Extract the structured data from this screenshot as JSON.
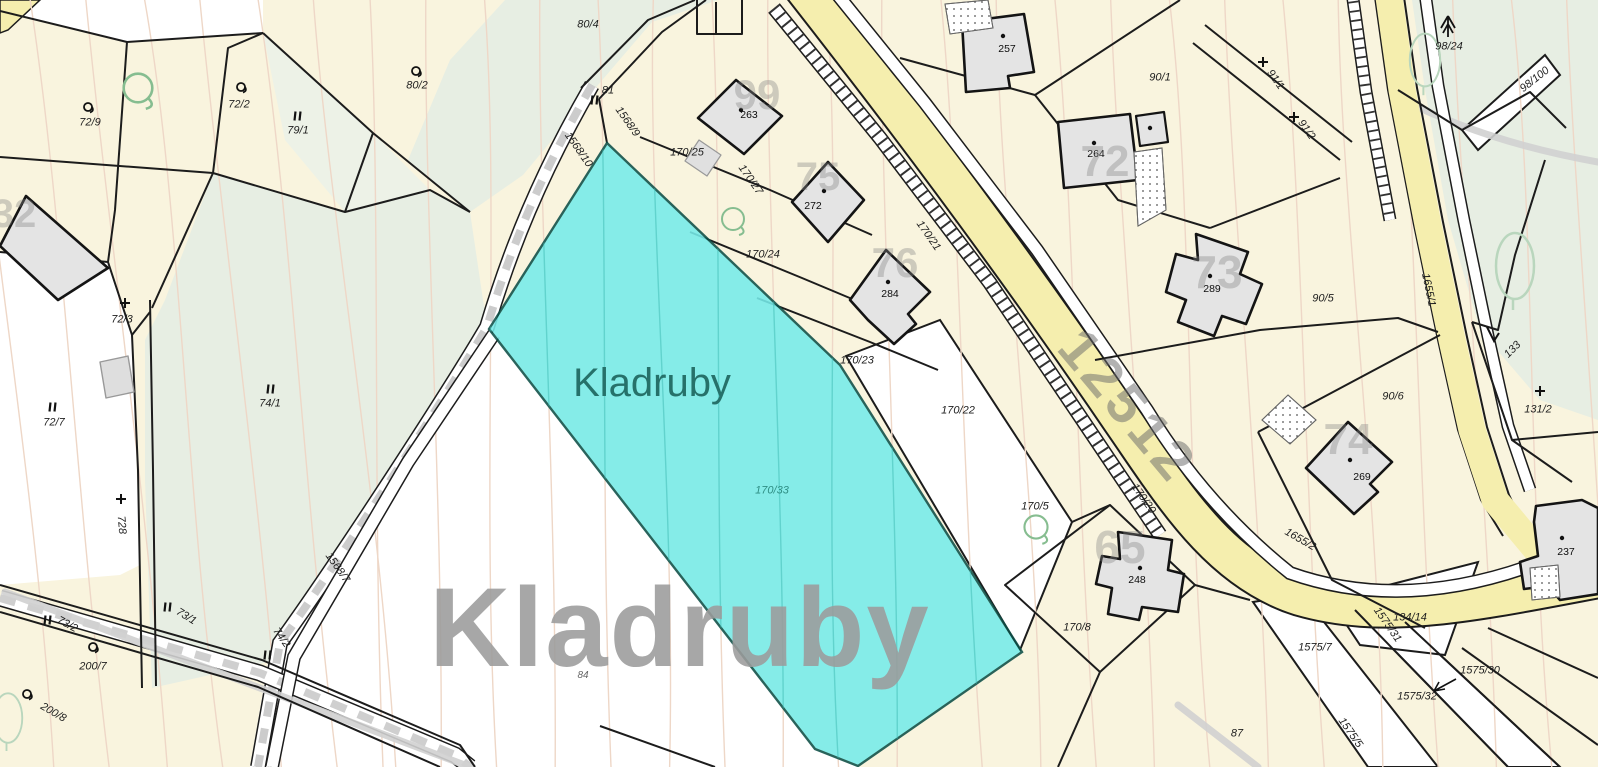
{
  "map": {
    "highlight": {
      "parcel": "170/33",
      "color": "#76ecea"
    },
    "colors": {
      "cream": "#f9f4de",
      "green": "#e7eee3",
      "pale_green": "#edf2e7",
      "highlight_cyan": "#76ecea",
      "road_yellow": "#f5eeae",
      "contour": "#eed7c7",
      "teal_text": "#26716a",
      "ghost_gray": "#9c9c9c"
    },
    "labels": [
      {
        "text": "72/9",
        "x": 90,
        "y": 123,
        "cls": "parcel"
      },
      {
        "text": "72/2",
        "x": 239,
        "y": 105,
        "cls": "parcel"
      },
      {
        "text": "79/1",
        "x": 298,
        "y": 131,
        "cls": "parcel"
      },
      {
        "text": "80/2",
        "x": 417,
        "y": 86,
        "cls": "parcel"
      },
      {
        "text": "80/4",
        "x": 588,
        "y": 25,
        "cls": "parcel"
      },
      {
        "text": "81",
        "x": 608,
        "y": 91,
        "cls": "parcel"
      },
      {
        "text": "90/1",
        "x": 1160,
        "y": 78,
        "cls": "parcel"
      },
      {
        "text": "98/24",
        "x": 1449,
        "y": 47,
        "cls": "parcel"
      },
      {
        "text": "170/25",
        "x": 687,
        "y": 153,
        "cls": "parcel"
      },
      {
        "text": "170/24",
        "x": 763,
        "y": 255,
        "cls": "parcel"
      },
      {
        "text": "170/23",
        "x": 857,
        "y": 361,
        "cls": "parcel"
      },
      {
        "text": "170/22",
        "x": 958,
        "y": 411,
        "cls": "parcel"
      },
      {
        "text": "170/5",
        "x": 1035,
        "y": 507,
        "cls": "parcel"
      },
      {
        "text": "170/8",
        "x": 1077,
        "y": 628,
        "cls": "parcel"
      },
      {
        "text": "90/5",
        "x": 1323,
        "y": 299,
        "cls": "parcel"
      },
      {
        "text": "90/6",
        "x": 1393,
        "y": 397,
        "cls": "parcel"
      },
      {
        "text": "131/2",
        "x": 1538,
        "y": 410,
        "cls": "parcel"
      },
      {
        "text": "134/14",
        "x": 1410,
        "y": 618,
        "cls": "parcel"
      },
      {
        "text": "1575/7",
        "x": 1315,
        "y": 648,
        "cls": "parcel"
      },
      {
        "text": "1575/30",
        "x": 1480,
        "y": 671,
        "cls": "parcel"
      },
      {
        "text": "1575/32",
        "x": 1417,
        "y": 697,
        "cls": "parcel"
      },
      {
        "text": "87",
        "x": 1237,
        "y": 734,
        "cls": "parcel"
      },
      {
        "text": "72/3",
        "x": 122,
        "y": 320,
        "cls": "parcel"
      },
      {
        "text": "72/7",
        "x": 54,
        "y": 423,
        "cls": "parcel"
      },
      {
        "text": "74/1",
        "x": 270,
        "y": 404,
        "cls": "parcel"
      },
      {
        "text": "200/7",
        "x": 93,
        "y": 667,
        "cls": "parcel"
      },
      {
        "text": "84",
        "x": 583,
        "y": 676,
        "cls": "parcel-gray"
      },
      {
        "text": "1568/10",
        "x": 578,
        "y": 150,
        "rot": 55,
        "cls": "parcel"
      },
      {
        "text": "1568/9",
        "x": 627,
        "y": 122,
        "rot": 55,
        "cls": "parcel"
      },
      {
        "text": "170/27",
        "x": 750,
        "y": 180,
        "rot": 55,
        "cls": "parcel"
      },
      {
        "text": "170/21",
        "x": 928,
        "y": 236,
        "rot": 55,
        "cls": "parcel"
      },
      {
        "text": "170/20",
        "x": 1143,
        "y": 499,
        "rot": 55,
        "cls": "parcel"
      },
      {
        "text": "1655/1",
        "x": 1428,
        "y": 290,
        "rot": 78,
        "cls": "parcel"
      },
      {
        "text": "1655/2",
        "x": 1300,
        "y": 540,
        "rot": 30,
        "cls": "parcel"
      },
      {
        "text": "98/100",
        "x": 1535,
        "y": 80,
        "rot": -38,
        "cls": "parcel"
      },
      {
        "text": "133",
        "x": 1513,
        "y": 350,
        "rot": -45,
        "cls": "parcel"
      },
      {
        "text": "1568/7",
        "x": 337,
        "y": 568,
        "rot": 55,
        "cls": "parcel"
      },
      {
        "text": "73/1",
        "x": 186,
        "y": 617,
        "rot": 32,
        "cls": "parcel"
      },
      {
        "text": "73/2",
        "x": 67,
        "y": 625,
        "rot": 28,
        "cls": "parcel"
      },
      {
        "text": "74/2",
        "x": 281,
        "y": 638,
        "rot": 55,
        "cls": "parcel"
      },
      {
        "text": "728",
        "x": 121,
        "y": 525,
        "rot": 85,
        "cls": "parcel"
      },
      {
        "text": "200/8",
        "x": 53,
        "y": 713,
        "rot": 30,
        "cls": "parcel"
      },
      {
        "text": "1575/31",
        "x": 1387,
        "y": 625,
        "rot": 55,
        "cls": "parcel"
      },
      {
        "text": "1575/5",
        "x": 1350,
        "y": 733,
        "rot": 55,
        "cls": "parcel"
      },
      {
        "text": "91/1",
        "x": 1275,
        "y": 80,
        "rot": 55,
        "cls": "parcel"
      },
      {
        "text": "91/2",
        "x": 1306,
        "y": 130,
        "rot": 55,
        "cls": "parcel"
      },
      {
        "text": "263",
        "x": 749,
        "y": 115,
        "cls": "building"
      },
      {
        "text": "257",
        "x": 1007,
        "y": 49,
        "cls": "building"
      },
      {
        "text": "272",
        "x": 813,
        "y": 206,
        "cls": "building"
      },
      {
        "text": "284",
        "x": 890,
        "y": 294,
        "cls": "building"
      },
      {
        "text": "264",
        "x": 1096,
        "y": 154,
        "cls": "building"
      },
      {
        "text": "289",
        "x": 1212,
        "y": 289,
        "cls": "building"
      },
      {
        "text": "269",
        "x": 1362,
        "y": 477,
        "cls": "building"
      },
      {
        "text": "248",
        "x": 1137,
        "y": 580,
        "cls": "building"
      },
      {
        "text": "237",
        "x": 1566,
        "y": 552,
        "cls": "building"
      },
      {
        "text": "99",
        "x": 757,
        "y": 95,
        "size": 42,
        "cls": "ghost"
      },
      {
        "text": "75",
        "x": 818,
        "y": 177,
        "size": 40,
        "cls": "ghost"
      },
      {
        "text": "76",
        "x": 895,
        "y": 263,
        "size": 42,
        "cls": "ghost"
      },
      {
        "text": "72",
        "x": 1105,
        "y": 162,
        "size": 44,
        "cls": "ghost"
      },
      {
        "text": "73",
        "x": 1217,
        "y": 272,
        "size": 46,
        "cls": "ghost"
      },
      {
        "text": "74",
        "x": 1348,
        "y": 440,
        "size": 44,
        "cls": "ghost"
      },
      {
        "text": "65",
        "x": 1120,
        "y": 547,
        "size": 46,
        "cls": "ghost"
      },
      {
        "text": "32",
        "x": 14,
        "y": 214,
        "size": 40,
        "cls": "ghost"
      },
      {
        "text": "12512",
        "x": 1128,
        "y": 406,
        "rot": 50,
        "size": 56,
        "cls": "road-big"
      },
      {
        "text": "Kladruby",
        "x": 652,
        "y": 383,
        "cls": "place-teal"
      },
      {
        "text": "Kladruby",
        "x": 680,
        "y": 628,
        "cls": "place-big"
      },
      {
        "text": "170/33",
        "x": 772,
        "y": 491,
        "cls": "parcel-teal"
      }
    ],
    "symbols": [
      {
        "type": "meadow",
        "x": 595,
        "y": 100
      },
      {
        "type": "meadow",
        "x": 298,
        "y": 116
      },
      {
        "type": "meadow",
        "x": 271,
        "y": 389
      },
      {
        "type": "meadow",
        "x": 53,
        "y": 407
      },
      {
        "type": "meadow",
        "x": 48,
        "y": 620
      },
      {
        "type": "meadow",
        "x": 168,
        "y": 607
      },
      {
        "type": "meadow",
        "x": 268,
        "y": 655
      },
      {
        "type": "garden",
        "x": 89,
        "y": 108
      },
      {
        "type": "garden",
        "x": 242,
        "y": 88
      },
      {
        "type": "garden",
        "x": 417,
        "y": 72
      },
      {
        "type": "garden",
        "x": 94,
        "y": 648
      },
      {
        "type": "garden",
        "x": 28,
        "y": 695
      },
      {
        "type": "plus",
        "x": 125,
        "y": 303
      },
      {
        "type": "plus",
        "x": 121,
        "y": 499
      },
      {
        "type": "plus",
        "x": 1540,
        "y": 391
      },
      {
        "type": "plus",
        "x": 1263,
        "y": 62
      },
      {
        "type": "plus",
        "x": 1294,
        "y": 117
      },
      {
        "type": "conifer",
        "x": 1448,
        "y": 25
      },
      {
        "type": "check",
        "x": 1494,
        "y": 336
      },
      {
        "type": "gtree",
        "x": 138,
        "y": 88,
        "s": 1.3
      },
      {
        "type": "gtree",
        "x": 733,
        "y": 219,
        "s": 1
      },
      {
        "type": "gtree",
        "x": 1036,
        "y": 527,
        "s": 1.05
      },
      {
        "type": "tree",
        "x": 1515,
        "y": 266,
        "s": 1
      },
      {
        "type": "tree",
        "x": 1425,
        "y": 60,
        "s": 0.8
      },
      {
        "type": "tree",
        "x": 8,
        "y": 718,
        "s": 0.75
      },
      {
        "type": "bdot",
        "x": 741,
        "y": 110
      },
      {
        "type": "bdot",
        "x": 1003,
        "y": 36
      },
      {
        "type": "bdot",
        "x": 824,
        "y": 191
      },
      {
        "type": "bdot",
        "x": 888,
        "y": 282
      },
      {
        "type": "bdot",
        "x": 1094,
        "y": 143
      },
      {
        "type": "bdot",
        "x": 1150,
        "y": 128
      },
      {
        "type": "bdot",
        "x": 1210,
        "y": 276
      },
      {
        "type": "bdot",
        "x": 1350,
        "y": 460
      },
      {
        "type": "bdot",
        "x": 1140,
        "y": 568
      },
      {
        "type": "bdot",
        "x": 1562,
        "y": 538
      },
      {
        "type": "arrow",
        "x": 1446,
        "y": 684
      }
    ]
  }
}
